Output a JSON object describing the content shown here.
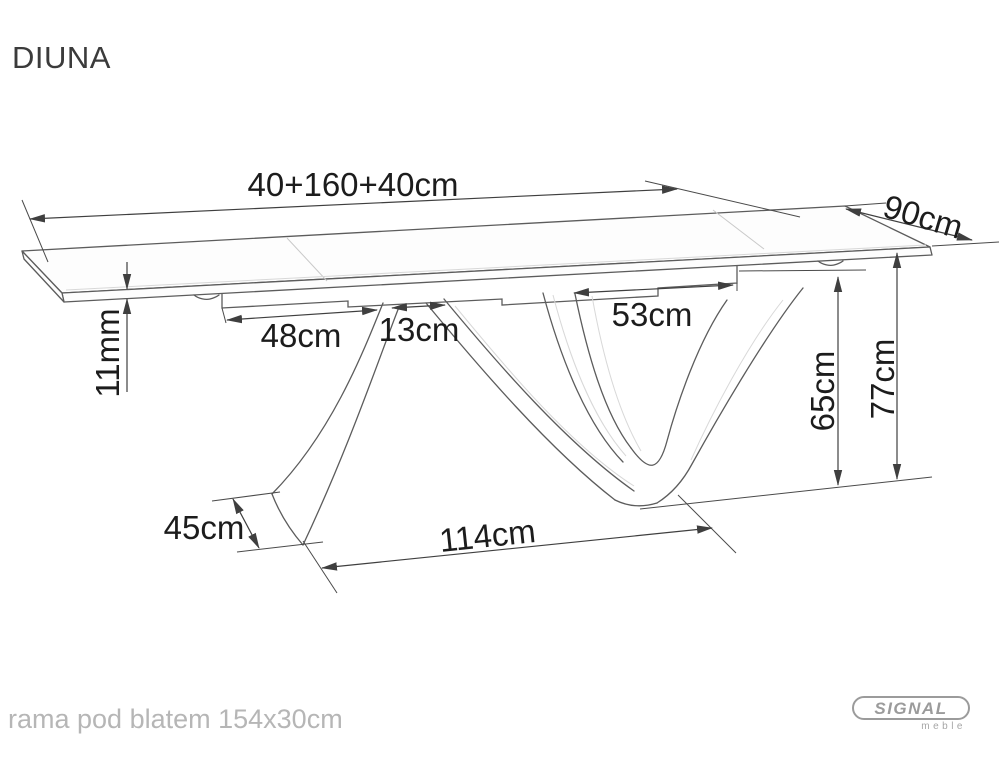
{
  "title": "DIUNA",
  "drawing": {
    "dimensions": {
      "top_length": "40+160+40cm",
      "depth": "90cm",
      "top_thickness": "11mm",
      "left_overhang": "48cm",
      "strut_top_width": "13cm",
      "right_overhang": "53cm",
      "apron_height": "65cm",
      "total_height": "77cm",
      "base_depth": "45cm",
      "base_length": "114cm"
    }
  },
  "footer": {
    "frame_note": "rama pod blatem 154x30cm"
  },
  "logo": {
    "brand": "SIGNAL",
    "sub_brand": "meble"
  },
  "colors": {
    "dimension_line": "#3f3f3f",
    "dimension_text": "#1c1c1c",
    "drawing_line": "#5c5c5c",
    "muted_text": "#b6b6b6",
    "logo_gray": "#9b9b9b"
  }
}
